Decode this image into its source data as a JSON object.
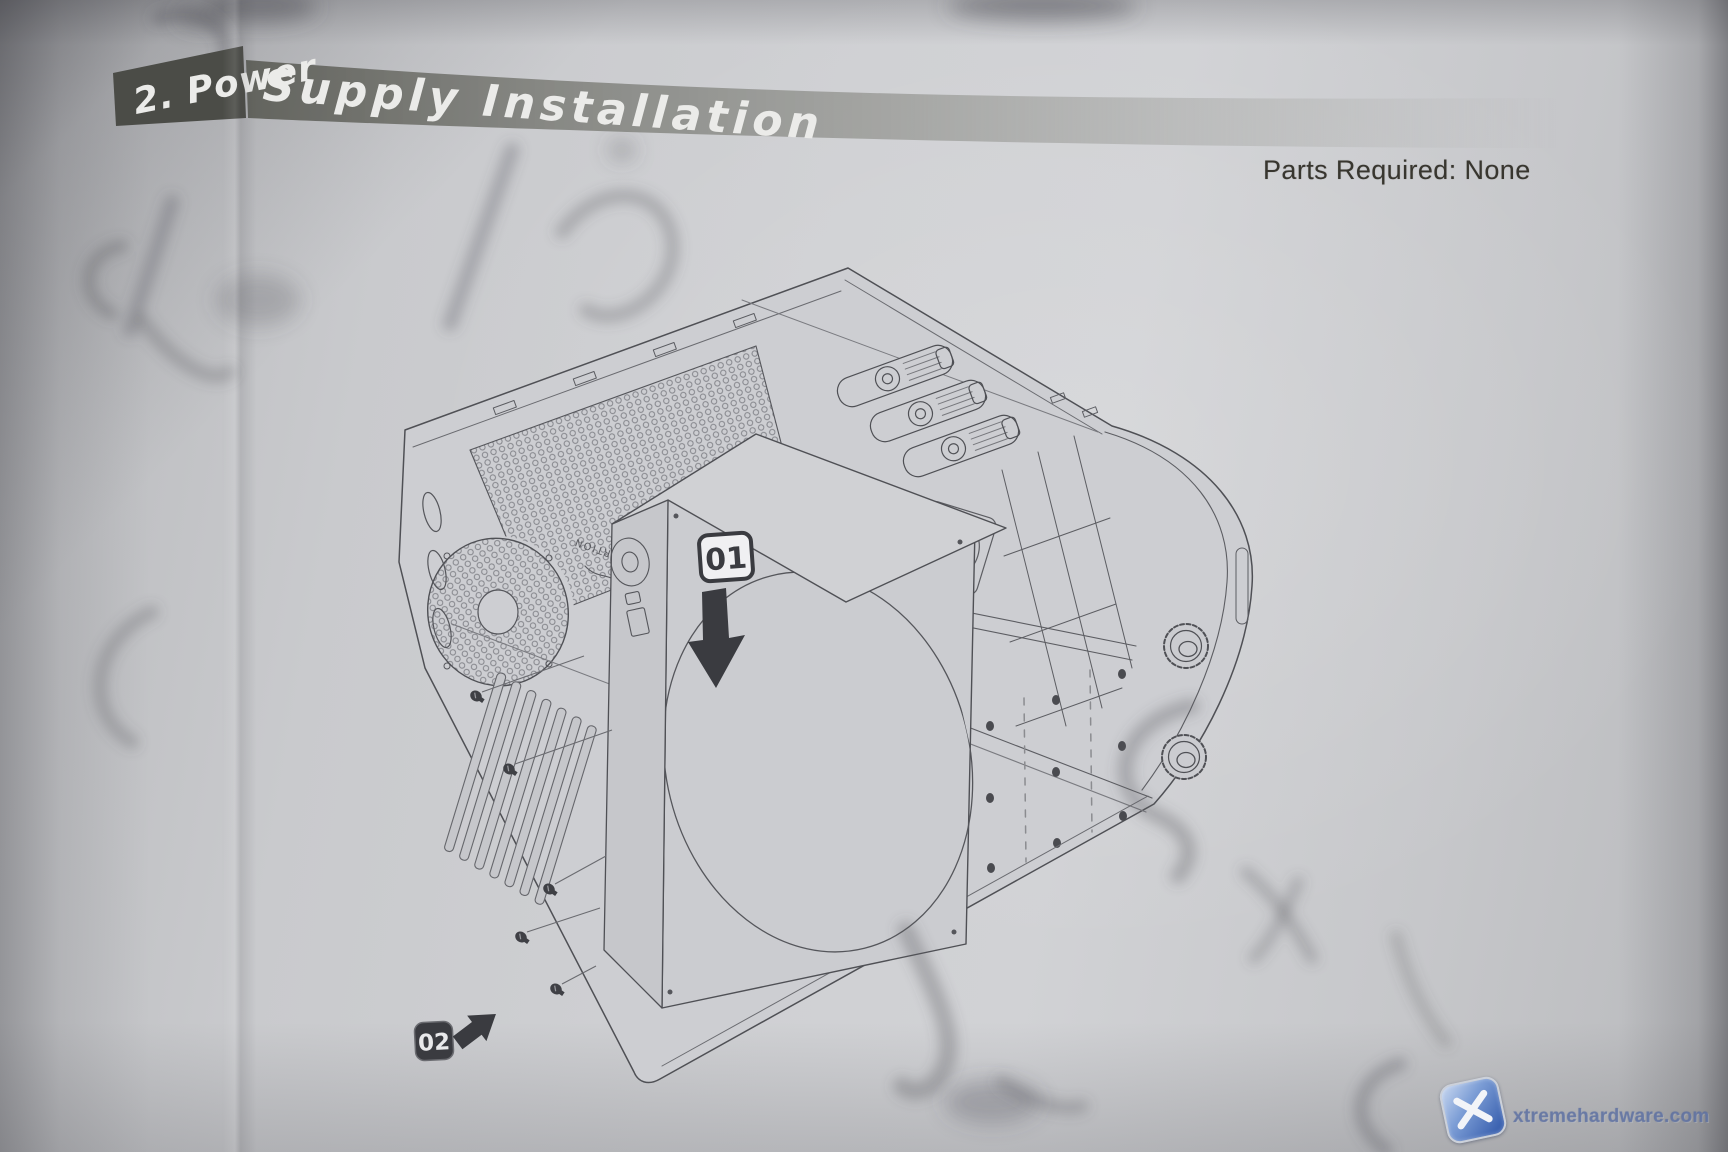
{
  "header": {
    "full_title": "2. Power Supply Installation",
    "title_part1": "2. Power",
    "title_part2": "Supply Installation",
    "parts_required": "Parts Required: None"
  },
  "diagram": {
    "step1_badge": "01",
    "step2_badge": "02",
    "psu_bay_text": "TOP PORTION",
    "screw_count": 5
  },
  "watermark": {
    "site": "xtremehardware.com"
  },
  "colors": {
    "banner_dark": "#4b4c47",
    "banner_mid": "#8a8b86",
    "page": "#cbccd0",
    "line": "#4f5055",
    "watermark_blue": "#3f66b5"
  }
}
